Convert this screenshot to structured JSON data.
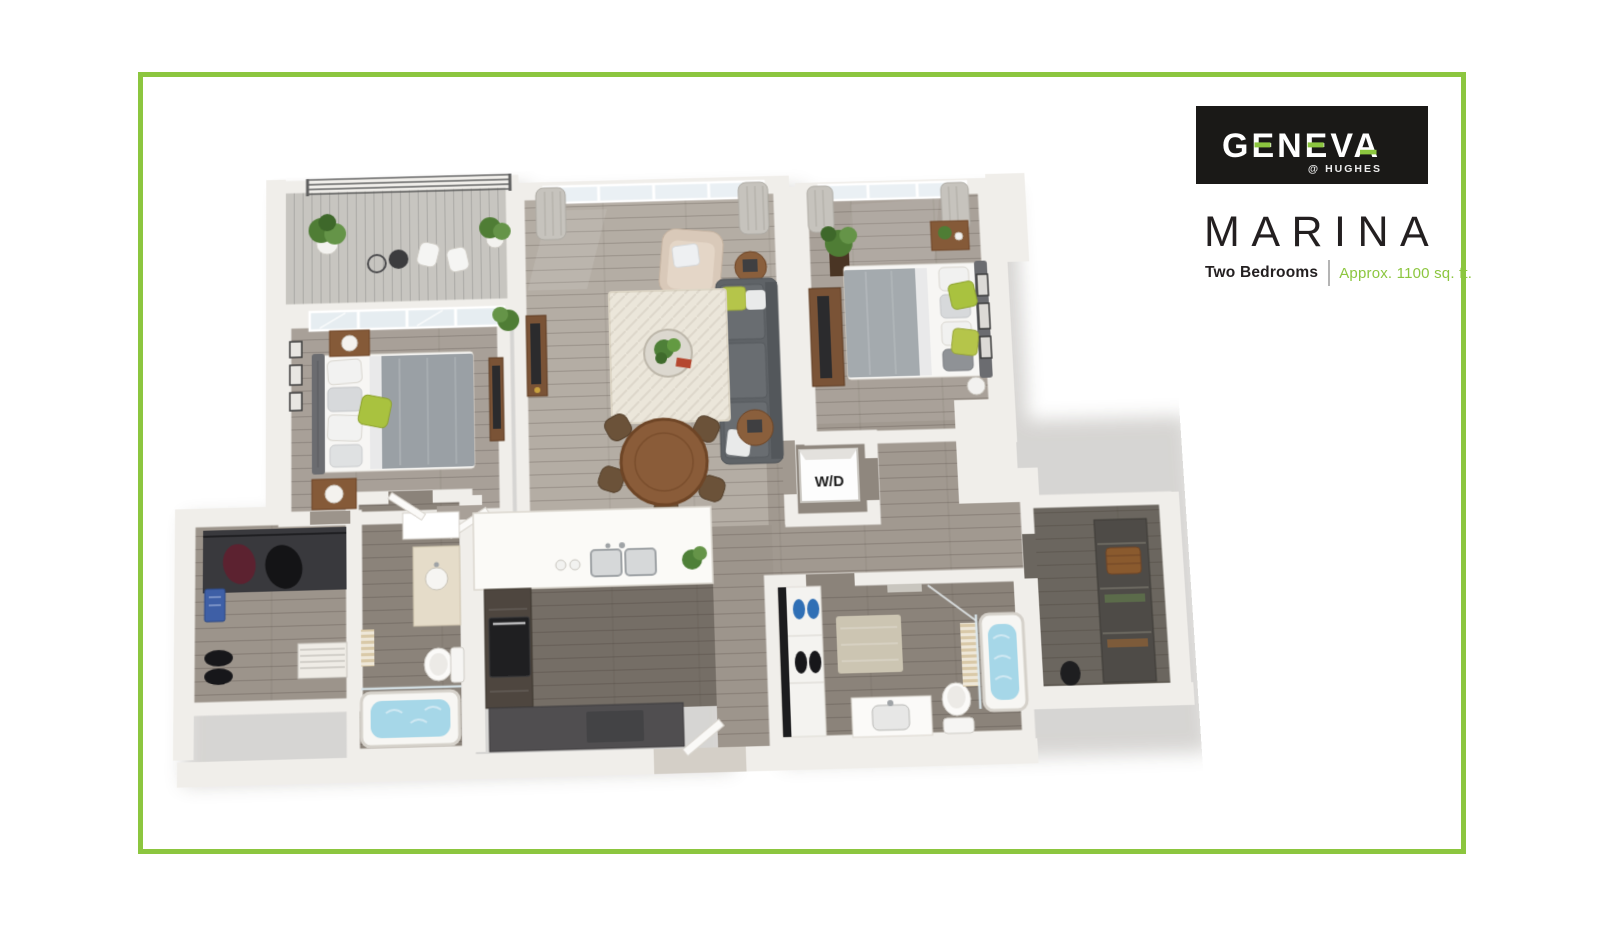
{
  "page": {
    "background": "#ffffff",
    "border_color": "#8cc63f"
  },
  "logo": {
    "brand": "GENEVA",
    "sub_brand": "@ HUGHES",
    "background": "#1a1917",
    "accent": "#8cc63f"
  },
  "plan_header": {
    "title": "MARINA",
    "bedrooms": "Two Bedrooms",
    "area": "Approx. 1100 sq. ft.",
    "accent": "#8cc63f",
    "text_color": "#231f20"
  },
  "floorplan": {
    "wd_label": "W/D"
  }
}
